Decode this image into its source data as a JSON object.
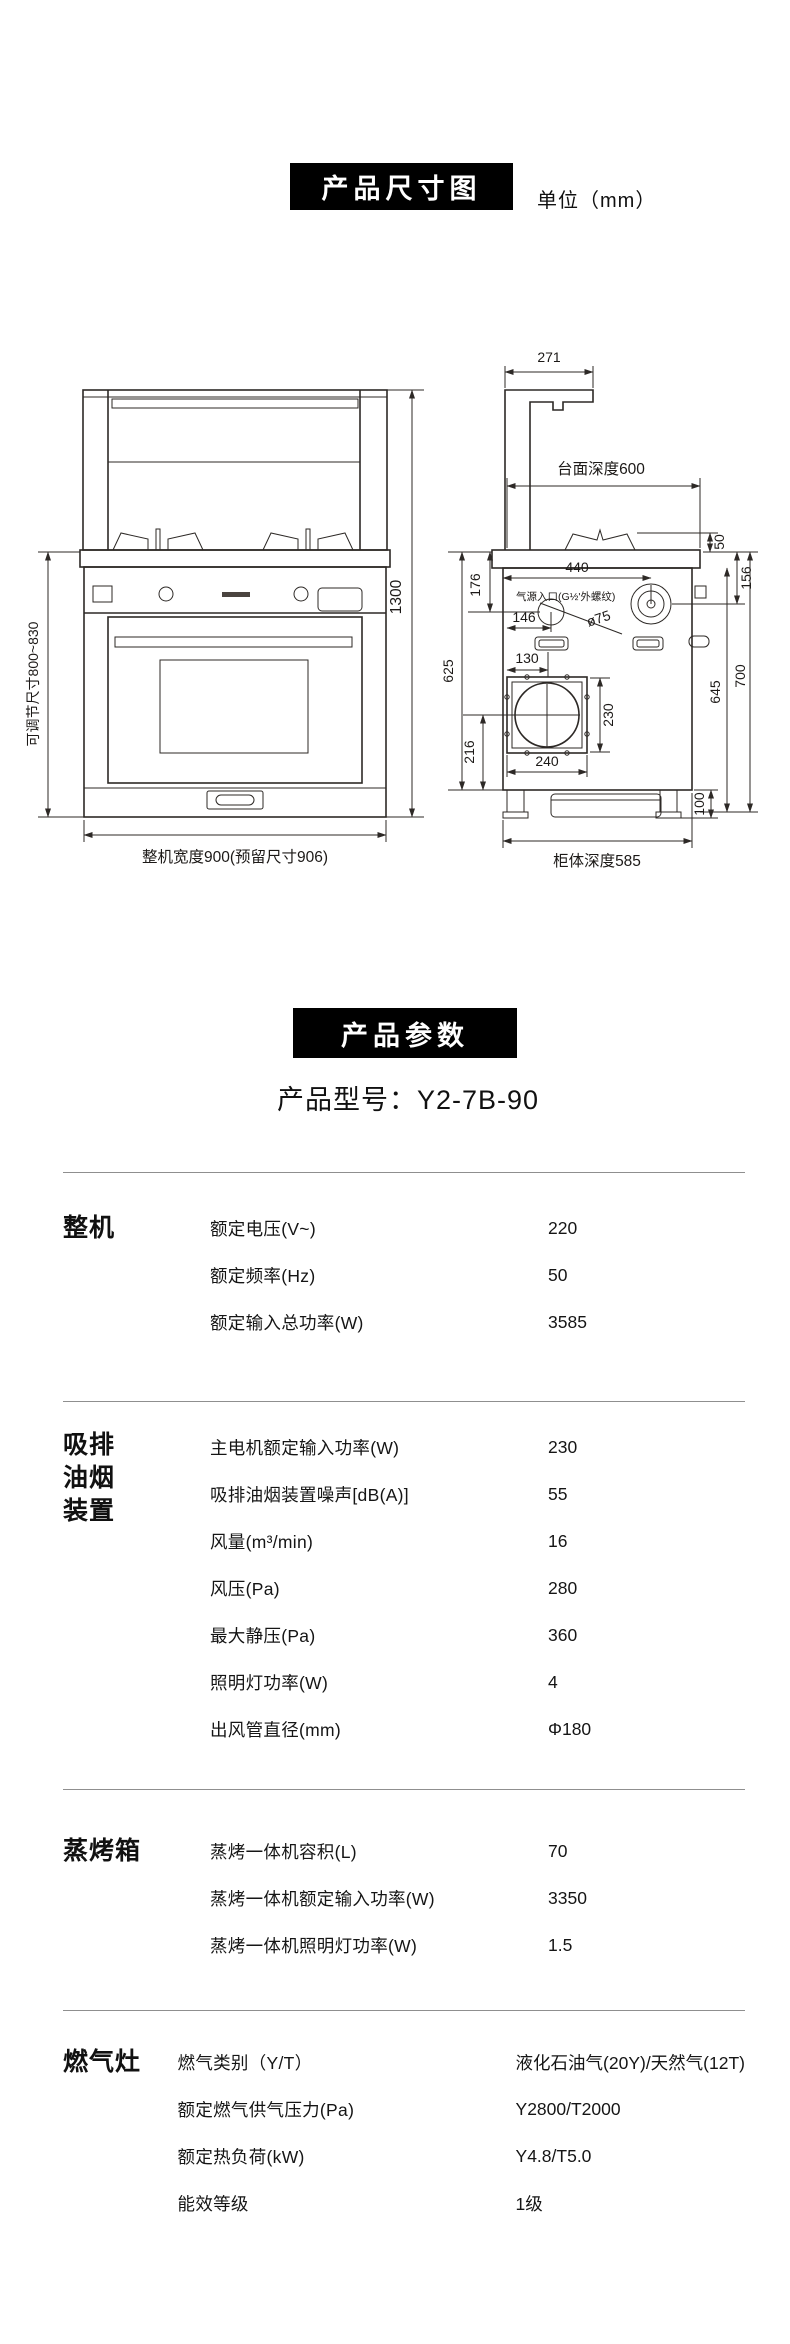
{
  "dimension_section": {
    "title": "产品尺寸图",
    "unit": "单位（mm）"
  },
  "params_section": {
    "title": "产品参数",
    "model": "产品型号：Y2-7B-90"
  },
  "diagram": {
    "front": {
      "height_total": "1300",
      "height_adjustable": "可调节尺寸800~830",
      "width_total": "整机宽度900(预留尺寸906)"
    },
    "side": {
      "duct_depth": "271",
      "counter_depth": "台面深度600",
      "burner_height": "50",
      "knob_drop": "156",
      "inlet_drop": "176",
      "knob_offset": "440",
      "gas_inlet": "气源入口(G½'外螺纹)",
      "inlet_offset": "146",
      "inlet_diameter": "ø75",
      "outlet_offset": "130",
      "counter_to_base": "625",
      "outlet_to_base": "216",
      "outlet_height": "230",
      "outlet_width": "240",
      "cabinet_height": "645",
      "overall_drop": "700",
      "foot_height": "100",
      "cabinet_depth": "柜体深度585"
    }
  },
  "specs": {
    "sections": [
      {
        "name": "整机",
        "rows": [
          {
            "label": "额定电压(V~)",
            "value": "220"
          },
          {
            "label": "额定频率(Hz)",
            "value": "50"
          },
          {
            "label": "额定输入总功率(W)",
            "value": "3585"
          }
        ]
      },
      {
        "name": "吸排油烟装置",
        "name_lines": [
          "吸排",
          "油烟",
          "装置"
        ],
        "rows": [
          {
            "label": "主电机额定输入功率(W)",
            "value": "230"
          },
          {
            "label": "吸排油烟装置噪声[dB(A)]",
            "value": "55"
          },
          {
            "label": "风量(m³/min)",
            "value": "16"
          },
          {
            "label": "风压(Pa)",
            "value": "280"
          },
          {
            "label": "最大静压(Pa)",
            "value": "360"
          },
          {
            "label": "照明灯功率(W)",
            "value": "4"
          },
          {
            "label": "出风管直径(mm)",
            "value": "Φ180"
          }
        ]
      },
      {
        "name": "蒸烤箱",
        "rows": [
          {
            "label": "蒸烤一体机容积(L)",
            "value": "70"
          },
          {
            "label": "蒸烤一体机额定输入功率(W)",
            "value": "3350"
          },
          {
            "label": "蒸烤一体机照明灯功率(W)",
            "value": "1.5"
          }
        ]
      },
      {
        "name": "燃气灶",
        "rows": [
          {
            "label": "燃气类别（Y/T）",
            "value": "液化石油气(20Y)/天然气(12T)"
          },
          {
            "label": "额定燃气供气压力(Pa)",
            "value": "Y2800/T2000"
          },
          {
            "label": "额定热负荷(kW)",
            "value": "Y4.8/T5.0"
          },
          {
            "label": "能效等级",
            "value": "1级"
          }
        ]
      }
    ]
  }
}
